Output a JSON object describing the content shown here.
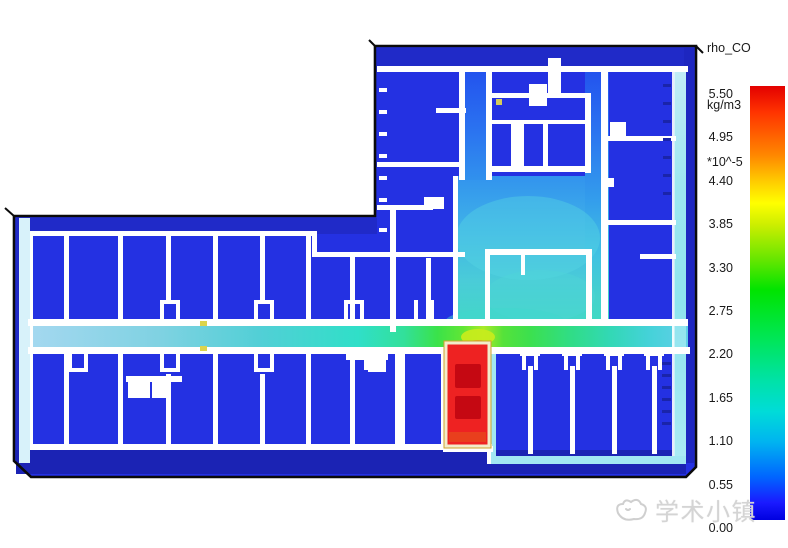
{
  "legend": {
    "title": "rho_CO",
    "units": "kg/m3",
    "scale": "*10^-5",
    "ticks": [
      "5.50",
      "4.95",
      "4.40",
      "3.85",
      "3.30",
      "2.75",
      "2.20",
      "1.65",
      "1.10",
      "0.55",
      "0.00"
    ]
  },
  "watermark": {
    "text": "学术小镇",
    "logo": "doodle-mascot-icon"
  },
  "colors": {
    "room_blue": "#2431e2",
    "band_blue": "#202ac8",
    "front_band_blue": "#1b23b4",
    "right_band_blue": "#1d26c0",
    "wall_white": "#ffffff",
    "edge_cyan": "#a2e7f2",
    "edge_cyan_pale": "#d8f2fa",
    "corridor_green": "#3ae24a",
    "corridor_yellow_peak": "#aaea28",
    "corridor_cyan": "#44d2d8",
    "upper_corridor_blue": "#2b74f0",
    "source_red": "#ee2222",
    "source_dark_red": "#c50812",
    "source_border_cream": "#f2ecca",
    "source_border_gold": "#cfa22c",
    "outline_black": "#0b0b0b",
    "colorbar_max_red": "#e30000",
    "colorbar_min_blue": "#0000e0",
    "watermark_gray": "#d4d4d4"
  },
  "chart_data": {
    "type": "heatmap",
    "title": "rho_CO",
    "units": "kg/m3",
    "scale_factor": 1e-05,
    "description": "CFD contour slice of CO density over an L-shaped building floor plan (smoke/CO dispersion simulation). Rainbow colormap: red = high CO, blue = low CO.",
    "colorbar": {
      "orientation": "vertical",
      "position": "right",
      "min": 0.0,
      "max": 5.5,
      "tick_step": 0.55,
      "ticks": [
        5.5,
        4.95,
        4.4,
        3.85,
        3.3,
        2.75,
        2.2,
        1.65,
        1.1,
        0.55,
        0.0
      ],
      "colormap": "rainbow"
    },
    "regions": [
      {
        "name": "source-room-with-two-vehicle-blocks",
        "value_x1e5": 5.5,
        "color": "red",
        "location": "just south of the main corridor, center of plan"
      },
      {
        "name": "corridor-at-source-doorway",
        "value_x1e5": 3.5,
        "color": "yellow-green",
        "location": "main east-west corridor above source room"
      },
      {
        "name": "main-corridor",
        "value_x1e5_range": [
          1.5,
          3.0
        ],
        "color": "green fading to cyan",
        "location": "east-west corridor spanning entire plan"
      },
      {
        "name": "north-wing-lobby-and-corridor",
        "value_x1e5_range": [
          1.0,
          2.0
        ],
        "color": "light blue to cyan",
        "location": "vertical corridor and open hall of upper wing"
      },
      {
        "name": "perimeter-edge-slots",
        "value_x1e5": 1.1,
        "color": "pale cyan",
        "location": "left and right building edges, lower-right room border"
      },
      {
        "name": "enclosed-rooms",
        "value_x1e5_range": [
          0.0,
          0.3
        ],
        "color": "blue",
        "location": "all closed rooms"
      }
    ]
  }
}
